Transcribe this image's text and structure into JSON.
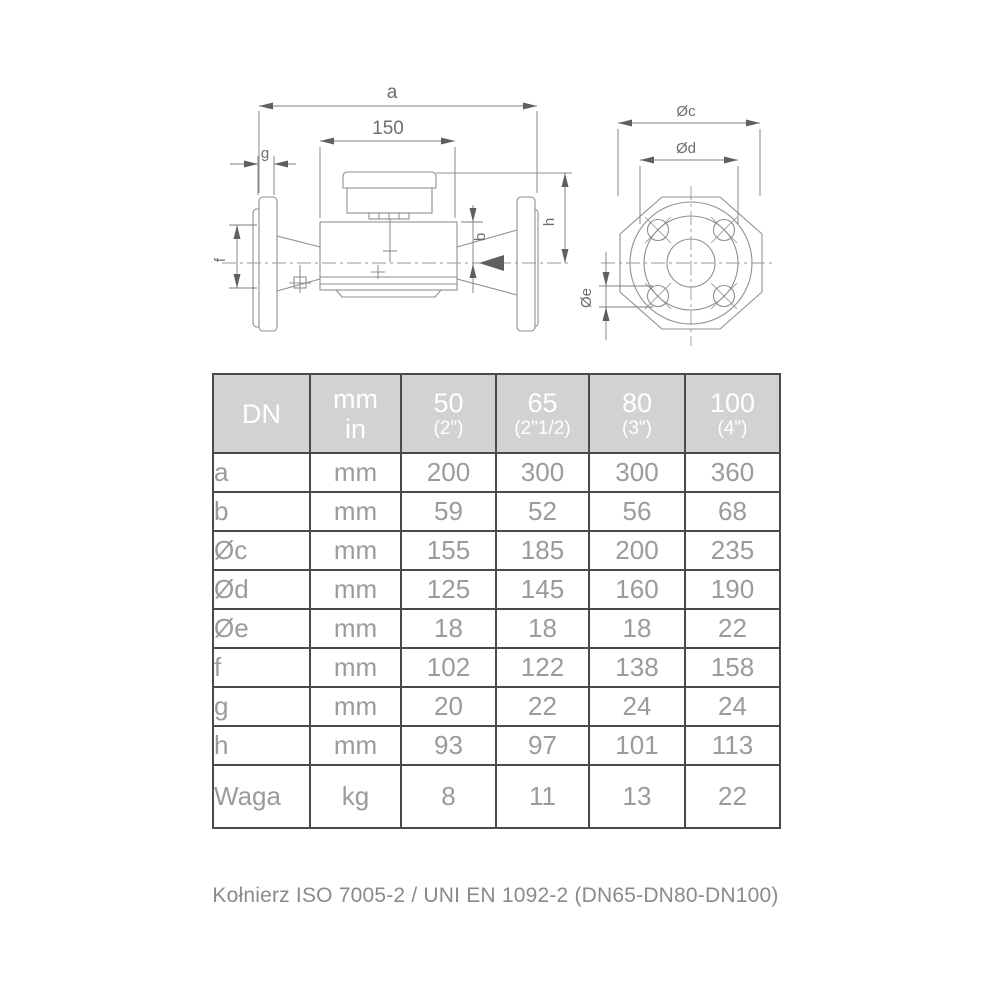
{
  "drawing": {
    "side_view": {
      "dim_a": "a",
      "dim_150": "150",
      "dim_g": "g",
      "dim_f": "f",
      "dim_b": "b",
      "dim_h": "h"
    },
    "front_view": {
      "dim_oc": "Øc",
      "dim_od": "Ød",
      "dim_oe": "Øe"
    }
  },
  "table": {
    "header": {
      "col_dn": "DN",
      "unit_line1": "mm",
      "unit_line2": "in",
      "sizes": [
        {
          "dn": "50",
          "inch": "(2\")"
        },
        {
          "dn": "65",
          "inch": "(2\"1/2)"
        },
        {
          "dn": "80",
          "inch": "(3\")"
        },
        {
          "dn": "100",
          "inch": "(4\")"
        }
      ]
    },
    "rows": [
      {
        "label": "a",
        "unit": "mm",
        "values": [
          "200",
          "300",
          "300",
          "360"
        ]
      },
      {
        "label": "b",
        "unit": "mm",
        "values": [
          "59",
          "52",
          "56",
          "68"
        ]
      },
      {
        "label": "Øc",
        "unit": "mm",
        "values": [
          "155",
          "185",
          "200",
          "235"
        ]
      },
      {
        "label": "Ød",
        "unit": "mm",
        "values": [
          "125",
          "145",
          "160",
          "190"
        ]
      },
      {
        "label": "Øe",
        "unit": "mm",
        "values": [
          "18",
          "18",
          "18",
          "22"
        ]
      },
      {
        "label": "f",
        "unit": "mm",
        "values": [
          "102",
          "122",
          "138",
          "158"
        ]
      },
      {
        "label": "g",
        "unit": "mm",
        "values": [
          "20",
          "22",
          "24",
          "24"
        ]
      },
      {
        "label": "h",
        "unit": "mm",
        "values": [
          "93",
          "97",
          "101",
          "113"
        ]
      },
      {
        "label": "Waga",
        "unit": "kg",
        "values": [
          "8",
          "11",
          "13",
          "22"
        ]
      }
    ]
  },
  "footer": {
    "note": "Kołnierz ISO 7005-2 / UNI EN 1092-2 (DN65-DN80-DN100)"
  },
  "colors": {
    "table_border": "#4a4a4c",
    "header_bg": "#d2d2d3",
    "header_text": "#ffffff",
    "cell_text": "#9b9b9b",
    "drawing_line": "#8f8f8f",
    "dim_line": "#7d7d7d",
    "dim_text": "#6e6e6e"
  }
}
